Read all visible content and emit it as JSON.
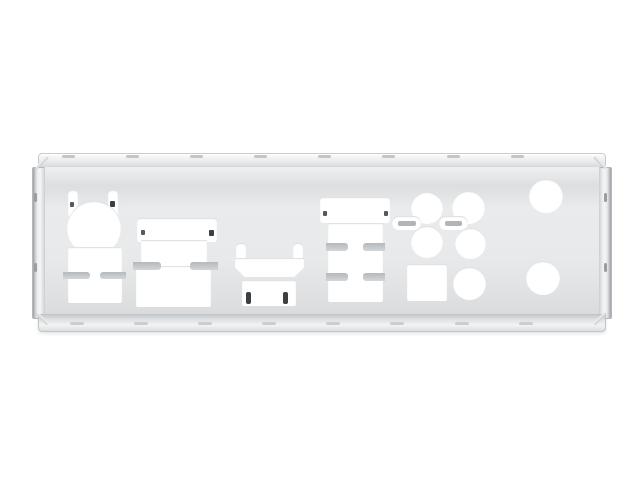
{
  "image": {
    "type": "product-photo",
    "subject": "Motherboard rear I/O shield backplate",
    "description": "Silver stainless-steel motherboard I/O shield plate with folded top and bottom flanges, side spring strips, and punched white cutouts: PS/2 port with spring-tab slots, dual-USB opening, USB/display combo block, HDMI opening with grounding clips, LAN-plus-USB block, five round audio jack holes, one square S/PDIF hole, two small tabbed vent slots, and two large round antenna holes.",
    "background_color": "#ffffff"
  },
  "colors": {
    "metal_light": "#f5f6f7",
    "metal_mid": "#e7e9eb",
    "metal_dark": "#c8cbce",
    "edge_line": "#b4b7ba",
    "cutout_white": "#ffffff",
    "tab_gray": "#c0c3c6",
    "clip_dark": "#3c4043"
  },
  "cutouts": {
    "ps2_port": {
      "label": "PS/2 port opening with two spring-tab slots"
    },
    "usb_block_left": {
      "label": "Dual USB opening with side retention tabs"
    },
    "usb_display_block": {
      "label": "USB / display combo opening with spring tabs"
    },
    "hdmi_port": {
      "label": "HDMI opening with grounding clips"
    },
    "lan_usb_block": {
      "label": "LAN + dual USB opening with two tab rows"
    },
    "audio_jacks": {
      "label": "Five round audio jack holes",
      "count": 5
    },
    "spdif_square": {
      "label": "Square S/PDIF opening"
    },
    "vent_slots": {
      "label": "Two small tabbed vent slots",
      "count": 2
    },
    "antenna_holes": {
      "label": "Two large round antenna holes",
      "count": 2
    }
  }
}
